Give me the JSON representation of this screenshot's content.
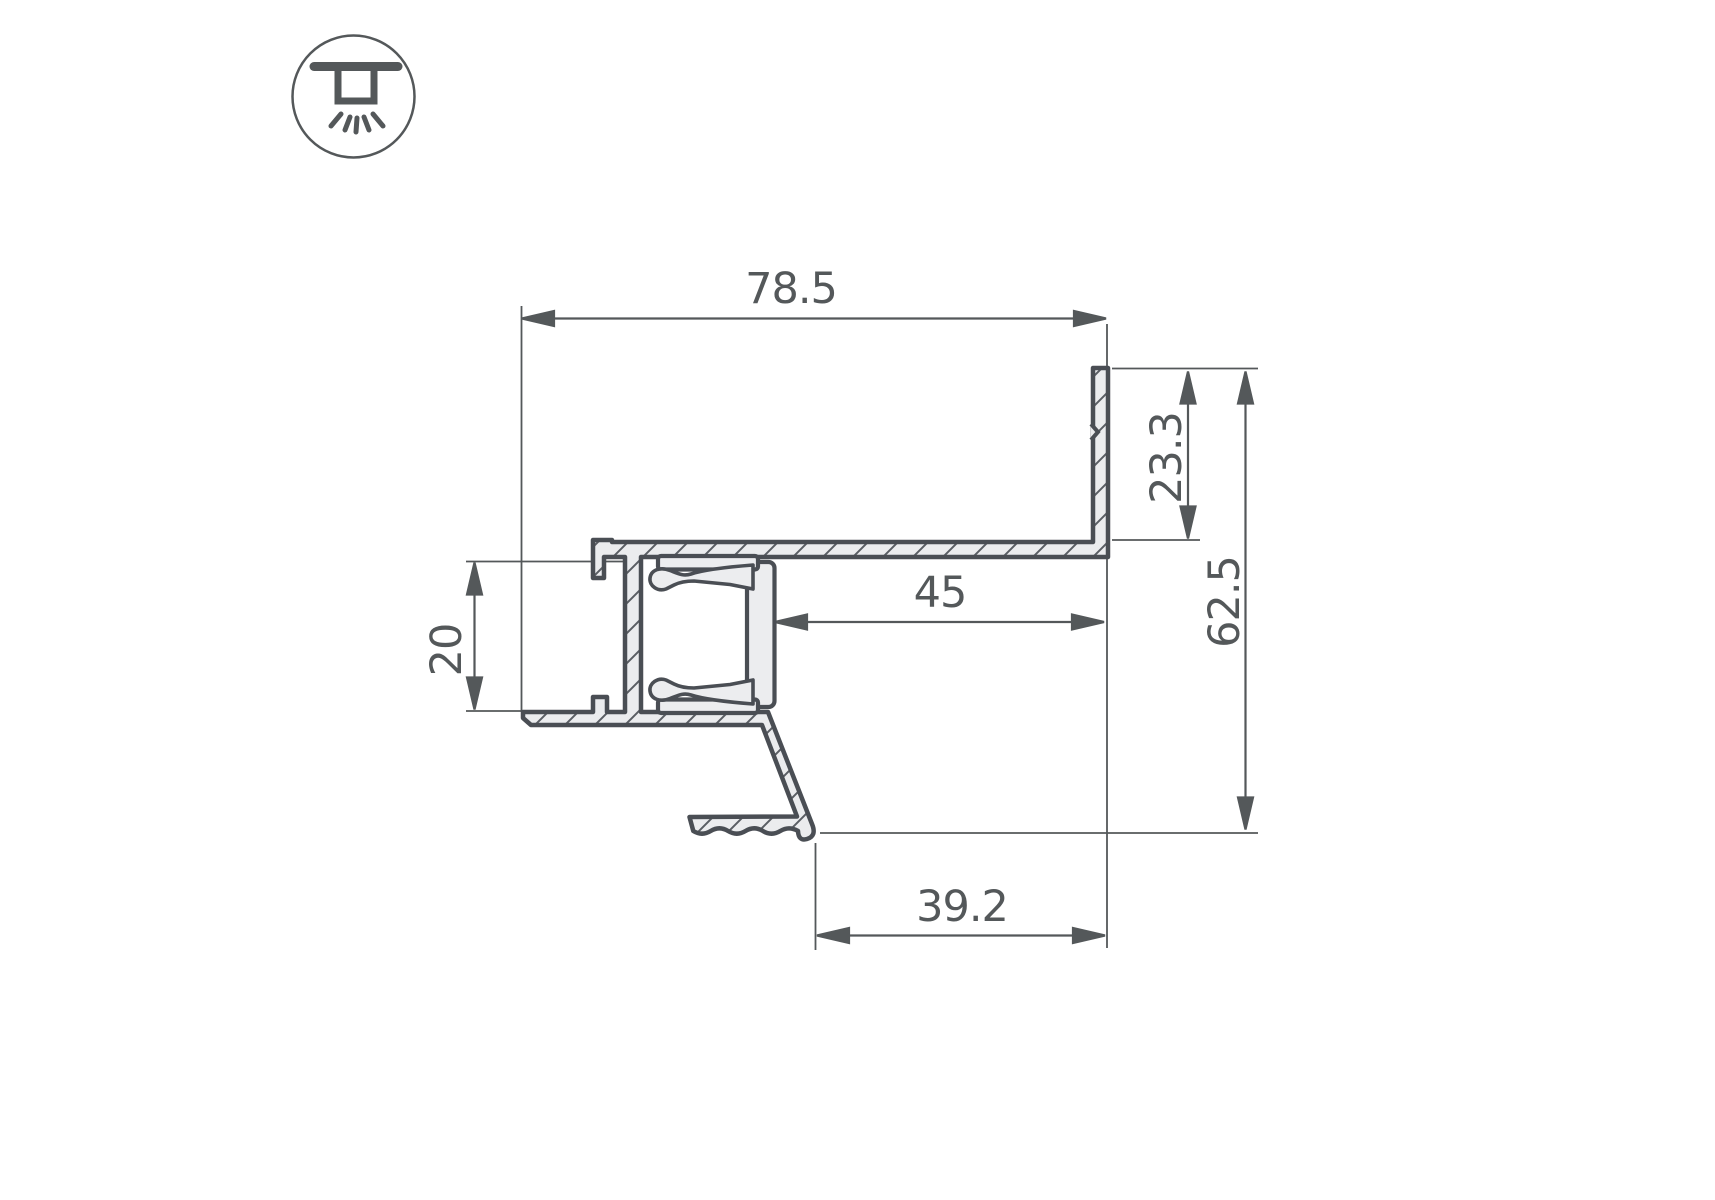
{
  "drawing": {
    "icon": {
      "name": "recessed-downlight"
    },
    "dims": {
      "overall_width": "78.5",
      "wall_height": "23.3",
      "overall_height": "62.5",
      "niche_width": "45",
      "channel_height": "20",
      "leg_offset": "39.2"
    },
    "colors": {
      "outline": "#4a4e54",
      "dimension": "#54585a",
      "profile_fill": "#ebecee",
      "background": "#ffffff"
    }
  }
}
